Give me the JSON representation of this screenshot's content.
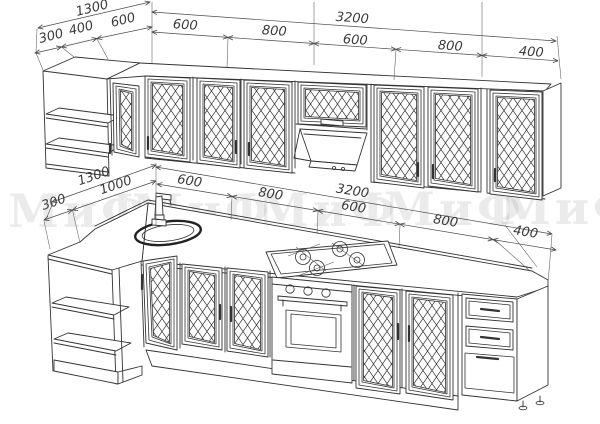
{
  "watermark": {
    "text": "МиФ",
    "color": "rgba(90,90,90,0.12)",
    "repeat_count": 5
  },
  "colors": {
    "background": "#ffffff",
    "line": "#333333",
    "dimension_text": "#3b3b3b"
  },
  "dimensions": {
    "upper_row": {
      "left_overall": "1300",
      "left_segments": [
        "300",
        "400",
        "600"
      ],
      "wall_overall": "3200",
      "wall_segments": [
        "600",
        "800",
        "600",
        "800",
        "400"
      ]
    },
    "lower_row": {
      "left_overall": "1300",
      "left_segments": [
        "300",
        "1000"
      ],
      "wall_overall": "3200",
      "wall_segments": [
        "600",
        "800",
        "600",
        "800",
        "400"
      ]
    }
  }
}
